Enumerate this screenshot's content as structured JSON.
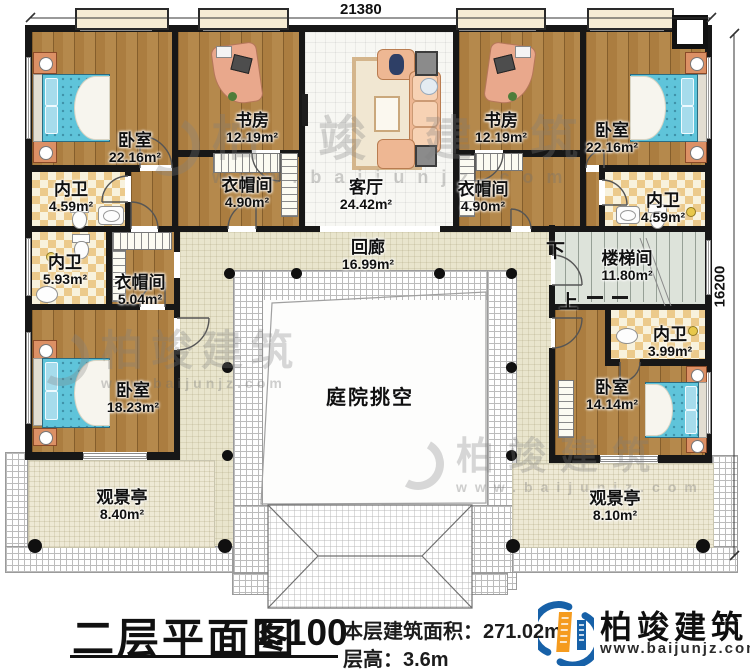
{
  "dims": {
    "width": "21380",
    "height": "16200"
  },
  "rooms": {
    "bedroom_tl": {
      "name": "卧室",
      "area": "22.16m²"
    },
    "study_l": {
      "name": "书房",
      "area": "12.19m²"
    },
    "living": {
      "name": "客厅",
      "area": "24.42m²"
    },
    "study_r": {
      "name": "书房",
      "area": "12.19m²"
    },
    "bedroom_tr": {
      "name": "卧室",
      "area": "22.16m²"
    },
    "bath_tl": {
      "name": "内卫",
      "area": "4.59m²"
    },
    "closet_l": {
      "name": "衣帽间",
      "area": "4.90m²"
    },
    "closet_r": {
      "name": "衣帽间",
      "area": "4.90m²"
    },
    "bath_tr": {
      "name": "内卫",
      "area": "4.59m²"
    },
    "bath_ml": {
      "name": "内卫",
      "area": "5.93m²"
    },
    "closet_ml": {
      "name": "衣帽间",
      "area": "5.04m²"
    },
    "bedroom_l": {
      "name": "卧室",
      "area": "18.23m²"
    },
    "stairwell": {
      "name": "楼梯间",
      "area": "11.80m²"
    },
    "bath_mr": {
      "name": "内卫",
      "area": "3.99m²"
    },
    "bedroom_r": {
      "name": "卧室",
      "area": "14.14m²"
    },
    "corridor": {
      "name": "回廊",
      "area": "16.99m²"
    },
    "courtyard": {
      "name": "庭院挑空"
    },
    "pavilion_l": {
      "name": "观景亭",
      "area": "8.40m²"
    },
    "pavilion_r": {
      "name": "观景亭",
      "area": "8.10m²"
    }
  },
  "stairs": {
    "down": "下",
    "up": "上"
  },
  "footer": {
    "title": "二层平面图",
    "scale": "1:100",
    "area_label": "本层建筑面积：",
    "area_value": "271.02m²",
    "height_label": "层高：",
    "height_value": "3.6m"
  },
  "brand": {
    "name": "柏竣建筑",
    "site": "www.baijunjz.com"
  },
  "watermark": {
    "name": "柏竣建筑",
    "site": "www.baijunjz.com"
  },
  "colors": {
    "wall": "#171717",
    "wood": "#ab7d40",
    "brand_blue": "#1761a8",
    "brand_orange": "#f59b1e",
    "bed_blue": "#5fc4da"
  }
}
